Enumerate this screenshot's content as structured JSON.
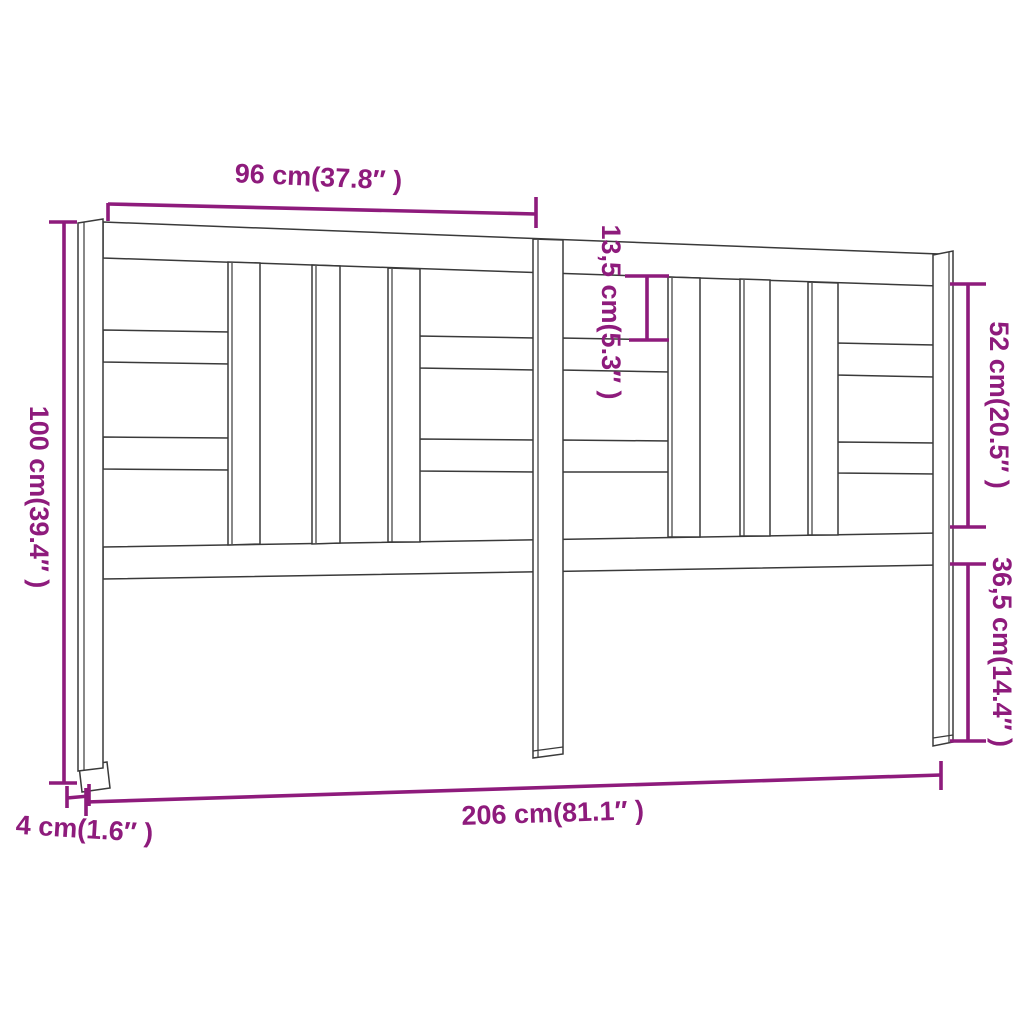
{
  "diagram": {
    "name": "headboard-dimension-diagram",
    "labels": {
      "section_width": "96 cm(37.8″ )",
      "opening_height": "13,5 cm(5.3″ )",
      "upper_height": "52 cm(20.5″ )",
      "total_height": "100 cm(39.4″ )",
      "lower_height": "36,5 cm(14.4″ )",
      "total_width": "206 cm(81.1″ )",
      "leg_thickness": "4 cm(1.6″ )"
    },
    "colors": {
      "dimension_accent": "#8e1b7c",
      "outline": "#3a3a3a",
      "background": "#ffffff"
    }
  }
}
